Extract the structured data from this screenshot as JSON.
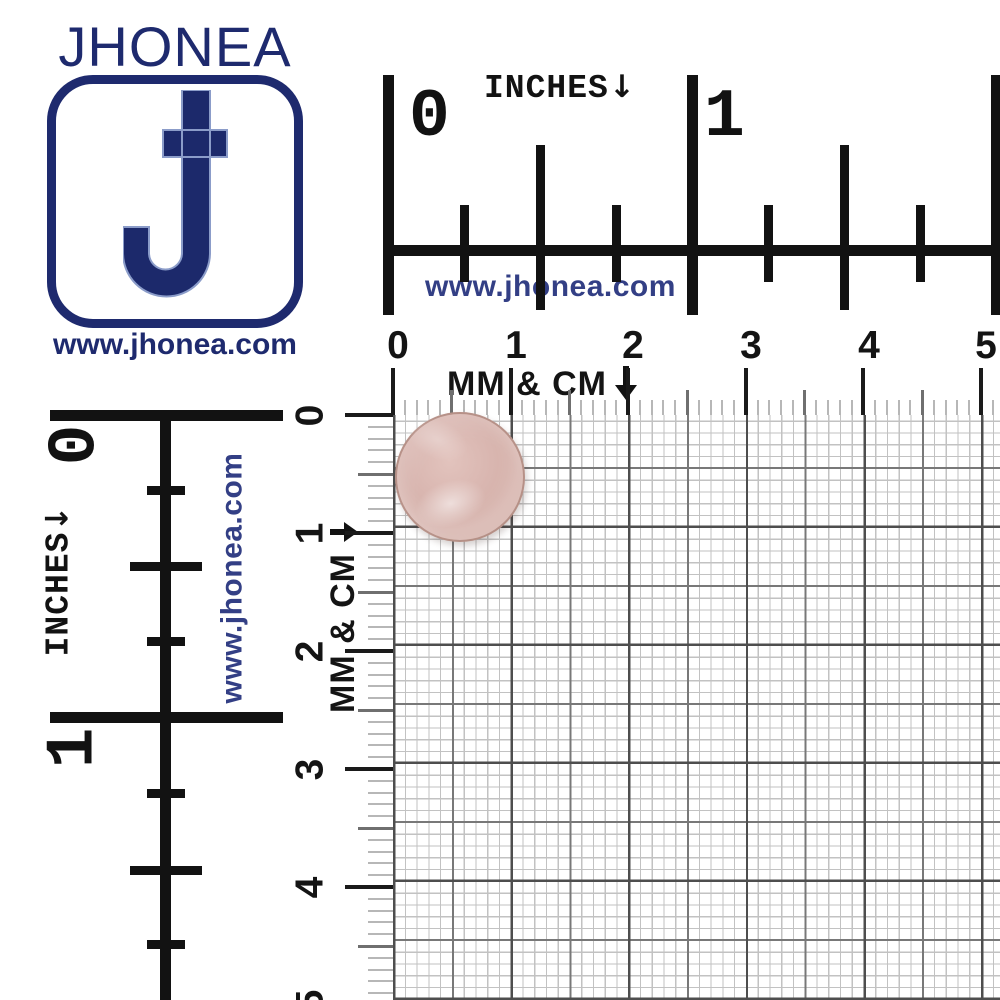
{
  "brand": {
    "name": "JHONEA",
    "website": "www.jhonea.com",
    "navy": "#1e2a6e",
    "link_blue": "#333f85"
  },
  "top_ruler_inches": {
    "numbers": [
      "0",
      "1"
    ],
    "label": "INCHES",
    "arrow": "↓",
    "website": "www.jhonea.com"
  },
  "top_scale_mm_cm": {
    "numbers": [
      "0",
      "1",
      "2",
      "3",
      "4",
      "5"
    ],
    "label": "MM & CM",
    "arrow": "↓"
  },
  "left_ruler_inches": {
    "numbers": [
      "0",
      "1"
    ],
    "label": "INCHES",
    "arrow": "↓",
    "website": "www.jhonea.com"
  },
  "left_scale_mm_cm": {
    "numbers": [
      "0",
      "1",
      "2",
      "3",
      "4",
      "5"
    ],
    "label": "MM & CM",
    "arrow": "→"
  },
  "colors": {
    "ruler_black": "#121212",
    "grid_line_cm": "#4e4e4e",
    "grid_line_5mm": "#787878",
    "grid_line_mm": "#c2c2c2",
    "button_face": "#d6b5af",
    "button_rim": "#8a5947"
  },
  "product": {
    "object": "round rose-gold metal button"
  }
}
